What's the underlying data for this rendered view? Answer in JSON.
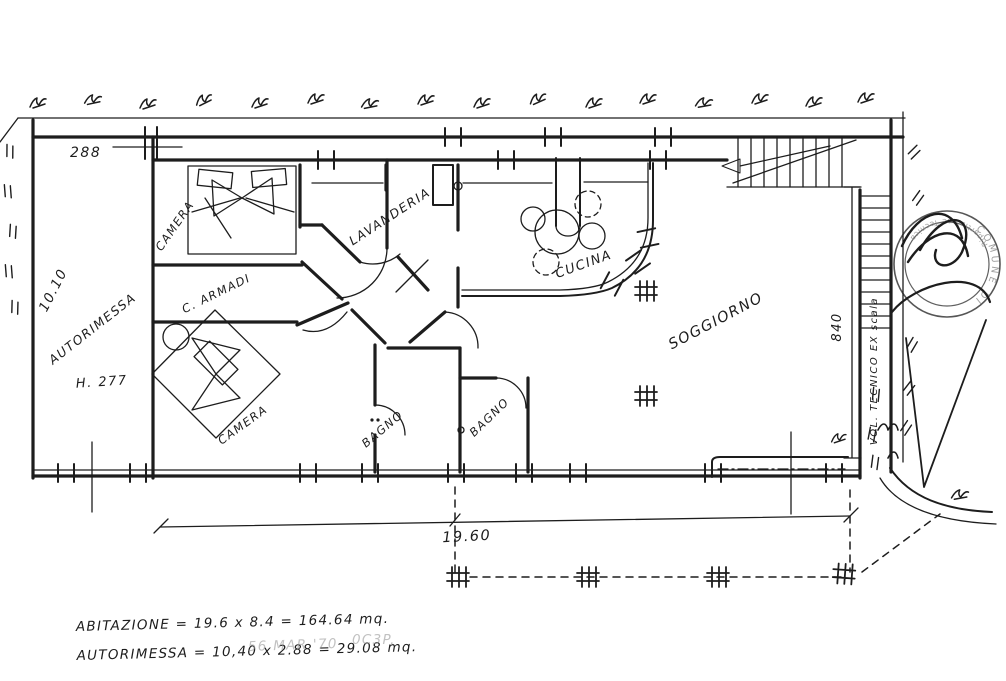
{
  "drawing": {
    "rooms": {
      "camera1": "CAMERA",
      "cabina_armadi": "C. ARMADI",
      "camera2": "CAMERA",
      "lavanderia": "LAVANDERIA",
      "cucina": "CUCINA",
      "soggiorno": "SOGGIORNO",
      "bagno1": "BAGNO",
      "bagno2": "BAGNO",
      "autorimessa": "AUTORIMESSA",
      "garage_height": "H. 277",
      "vol_tecnico": "VOL. TECNICO EX scala"
    },
    "dimensions": {
      "garage_width": "288",
      "garage_length": "10.10",
      "house_height": "840",
      "house_width": "19.60"
    },
    "annotations": {
      "area_line1": "ABITAZIONE = 19.6 x 8.4 = 164.64 mq.",
      "area_line2": "AUTORIMESSA = 10,40 x 2.88 = 29.08 mq.",
      "faded_date_stamp": "56 MAR '70",
      "faded_protocol": "0C3P."
    },
    "stamp": {
      "ring_top": "Ripartizione Tecnica",
      "ring_right": "COMUNE DI"
    },
    "colors": {
      "ink": "#1d1d1d",
      "faded": "#999999",
      "paper": "#ffffff"
    }
  }
}
